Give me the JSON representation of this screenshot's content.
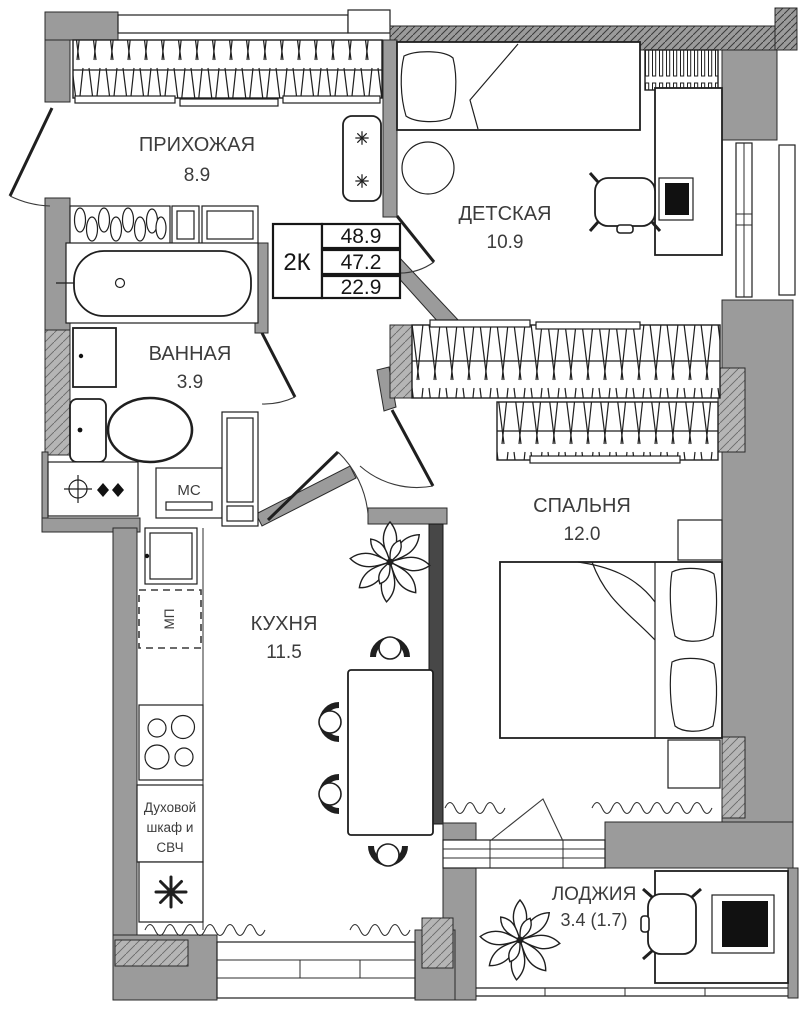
{
  "plan": {
    "colors": {
      "wall": "#9b9b9b",
      "partition": "#474747",
      "line": "#1f1f1f",
      "floor": "#ffffff"
    },
    "rooms": {
      "hallway": {
        "name": "ПРИХОЖАЯ",
        "area": "8.9"
      },
      "kids": {
        "name": "ДЕТСКАЯ",
        "area": "10.9"
      },
      "bath": {
        "name": "ВАННАЯ",
        "area": "3.9"
      },
      "bedroom": {
        "name": "СПАЛЬНЯ",
        "area": "12.0"
      },
      "kitchen": {
        "name": "КУХНЯ",
        "area": "11.5"
      },
      "loggia": {
        "name": "ЛОДЖИЯ",
        "area": "3.4 (1.7)"
      }
    },
    "info_table": {
      "type_label": "2К",
      "row1": "48.9",
      "row2": "47.2",
      "row3": "22.9"
    },
    "labels": {
      "washing_machine": "МС",
      "microwave_place": "МП",
      "oven_line1": "Духовой",
      "oven_line2": "шкаф и",
      "oven_line3": "СВЧ"
    }
  }
}
